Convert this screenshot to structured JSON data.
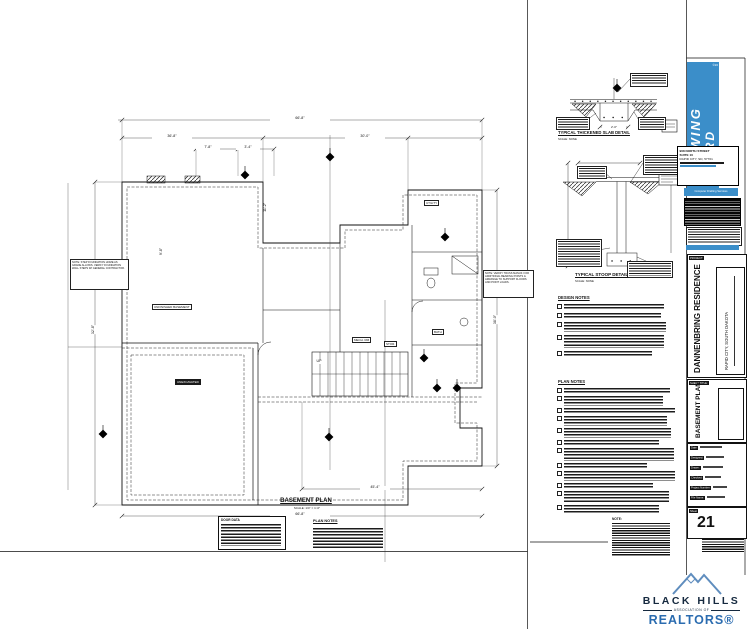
{
  "plan": {
    "title": "BASEMENT PLAN",
    "scale": "SCALE: 1/4\" = 1'-0\"",
    "door_data_title": "DOOR DATA",
    "plan_notes_title": "PLAN NOTES",
    "rooms": {
      "main": "UNFINISHED BASEMENT",
      "unexcavated": "UNEXCAVATED",
      "mech": "MECH. RM",
      "stor": "STOR.",
      "bath": "BATH",
      "utility": "UTILITY",
      "up": "UP"
    },
    "notes": {
      "left": "NOTE: STEP FOUNDATION HOME AS GRADE ALLOWS. VERIFY FOUNDATION WALL STEPS W/ GENERAL CONTRACTOR.",
      "right": "NOTE: VERIFY TRUSS MANUF. FOR ADDITIONAL BEARING POINTS & ARRANGE TO SUPPORT FLOORS AND POINT LOADS."
    },
    "dims": {
      "top_overall": "66'-8\"",
      "top_left": "36'-8\"",
      "top_right": "30'-0\"",
      "sub_a": "7'-8\"",
      "sub_b": "3'-4\"",
      "left": "32'-8\"",
      "right": "38'-0\"",
      "int_v": "11'-2\"",
      "int_h": "9'-8\"",
      "bottom": "45'-4\"",
      "bottom_overall": "66'-8\""
    }
  },
  "details": {
    "slab": {
      "title": "TYPICAL THICKENED SLAB DETAIL",
      "scale": "SCALE: NONE",
      "dim": "2'-0\""
    },
    "stoop": {
      "title": "TYPICAL STOOP DETAIL",
      "scale": "SCALE: NONE"
    },
    "design_notes_title": "DESIGN NOTES",
    "plan_notes_title": "PLAN NOTES",
    "note_label": "NOTE:"
  },
  "titleblock": {
    "logo": {
      "line1": "DRAWING",
      "line2": "BOARD",
      "mark": "©20",
      "tagline": "Computer Drafting Services"
    },
    "address": [
      "908 NORTH STREET",
      "SUITE 10",
      "RAPID CITY, SD, 57701"
    ],
    "project_label": "PROJECT:",
    "project_name": "DANNENBRING RESIDENCE",
    "project_location": "RAPID CITY, SOUTH DAKOTA",
    "sheet_title_label": "SHEET TITLE:",
    "sheet_title": "BASEMENT PLAN",
    "fields": [
      {
        "label": "Date:"
      },
      {
        "label": "Designed:"
      },
      {
        "label": "Drawn:"
      },
      {
        "label": "Checked:"
      },
      {
        "label": "Project Number:"
      },
      {
        "label": "File Name:"
      }
    ],
    "sheet_label": "Sheet",
    "sheet_number": "21"
  },
  "realtor": {
    "line1": "BLACK HILLS",
    "line2": "ASSOCIATION OF",
    "line3": "REALTORS®"
  },
  "colors": {
    "logo_blue": "#3b8ec9",
    "navy": "#15293f",
    "realtor_blue": "#2b6cb0"
  }
}
